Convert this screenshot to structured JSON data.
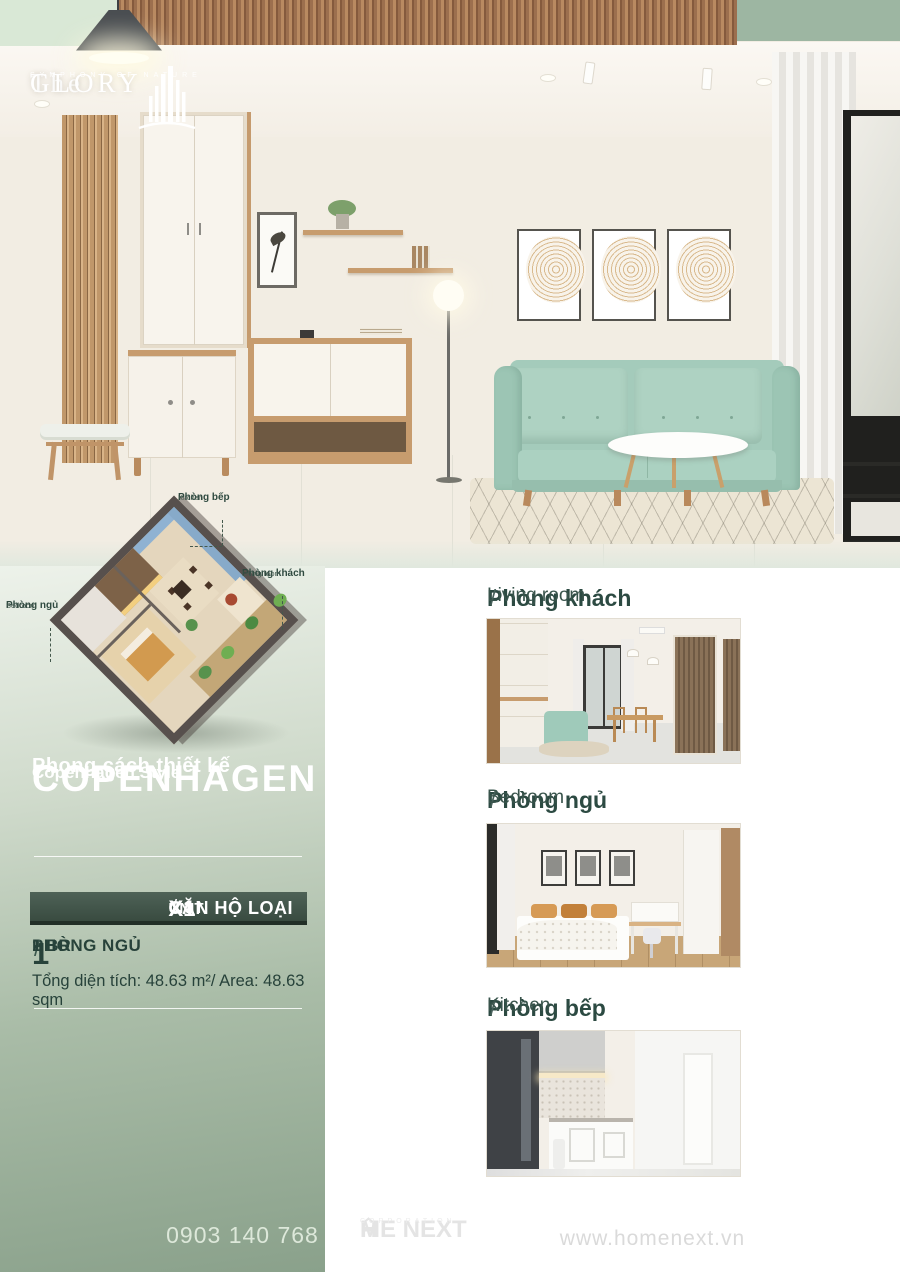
{
  "brand": {
    "name_prefix": "The",
    "name_main": "GLORY",
    "tagline": "SYMPHONY OF NATURE"
  },
  "floorplan": {
    "labels": [
      {
        "vn": "Phòng bếp",
        "en": "Kitchen"
      },
      {
        "vn": "Phòng khách",
        "en": "Living room"
      },
      {
        "vn": "Phòng ngủ",
        "en": "Bedroom"
      }
    ]
  },
  "style_block": {
    "pre": "Phong cách thiết kế",
    "title": "COPENHAGEN",
    "sub": "Copenhagen Style"
  },
  "unit": {
    "vn_label": "CĂN HỘ LOẠI",
    "vn_code": "X1",
    "sep": "/",
    "en_label": "UNIT",
    "en_code": "X1"
  },
  "details": {
    "count": "1",
    "vn": "PHÒNG NGỦ",
    "sep": "/",
    "en": "1 BR",
    "area": "Tổng diện tích: 48.63 m²/ Area: 48.63 sqm"
  },
  "sections": [
    {
      "vn": "Phòng khách",
      "sep": "/",
      "en": "Living room"
    },
    {
      "vn": "Phòng ngủ",
      "sep": "/",
      "en": "Bedroom"
    },
    {
      "vn": "Phòng bếp",
      "sep": "/",
      "en": "Kitchen"
    }
  ],
  "footer": {
    "phone": "0903 140 768",
    "logo_part1": "H",
    "logo_part2": "ME NEXT",
    "logo_sub": "CORPORATION",
    "website": "www.homenext.vn"
  },
  "colors": {
    "accent_dark_green": "#2c4a42",
    "badge_green": "#394b40",
    "panel_sage_top": "#edf2ea",
    "panel_sage_bottom": "#8aa18b",
    "sofa_teal": "#a4cbbb",
    "wood": "#c79c6e"
  }
}
